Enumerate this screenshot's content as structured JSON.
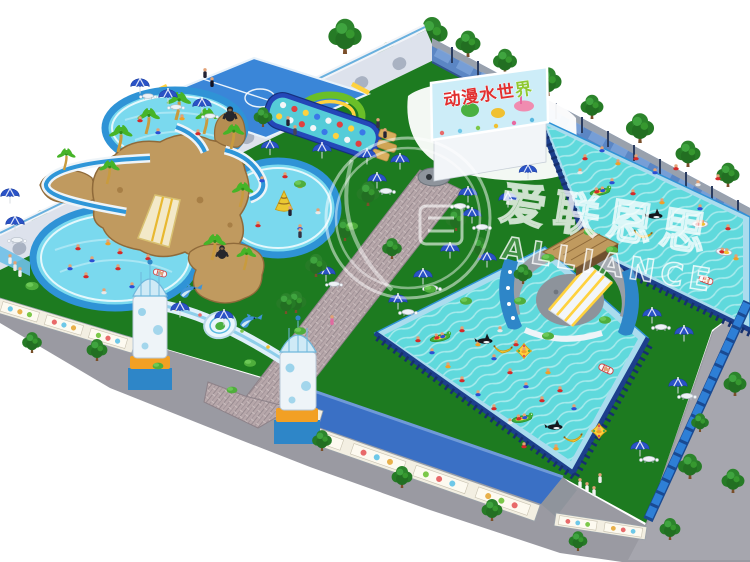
{
  "billboard": {
    "title_main": "动漫水世",
    "title_accent": "界"
  },
  "watermark": {
    "cn": "爱联恩思",
    "en": "ALLIANCE"
  },
  "palette": {
    "lawn_green": "#1d7b20",
    "pool_water": "#5fd9dc",
    "pool_tube_blue": "#2f93d6",
    "frame_navy": "#1c3f8c",
    "fence_wall_blue": "#5b86c4",
    "brick_path": "#b7a7aa",
    "pavement_grey": "#9a9aa2",
    "roof_blue": "#3a70c5",
    "umbrella_blue": "#2a52c6",
    "accent_orange": "#f2a024",
    "tree_green": "#267b26",
    "billboard_red": "#e13030"
  }
}
